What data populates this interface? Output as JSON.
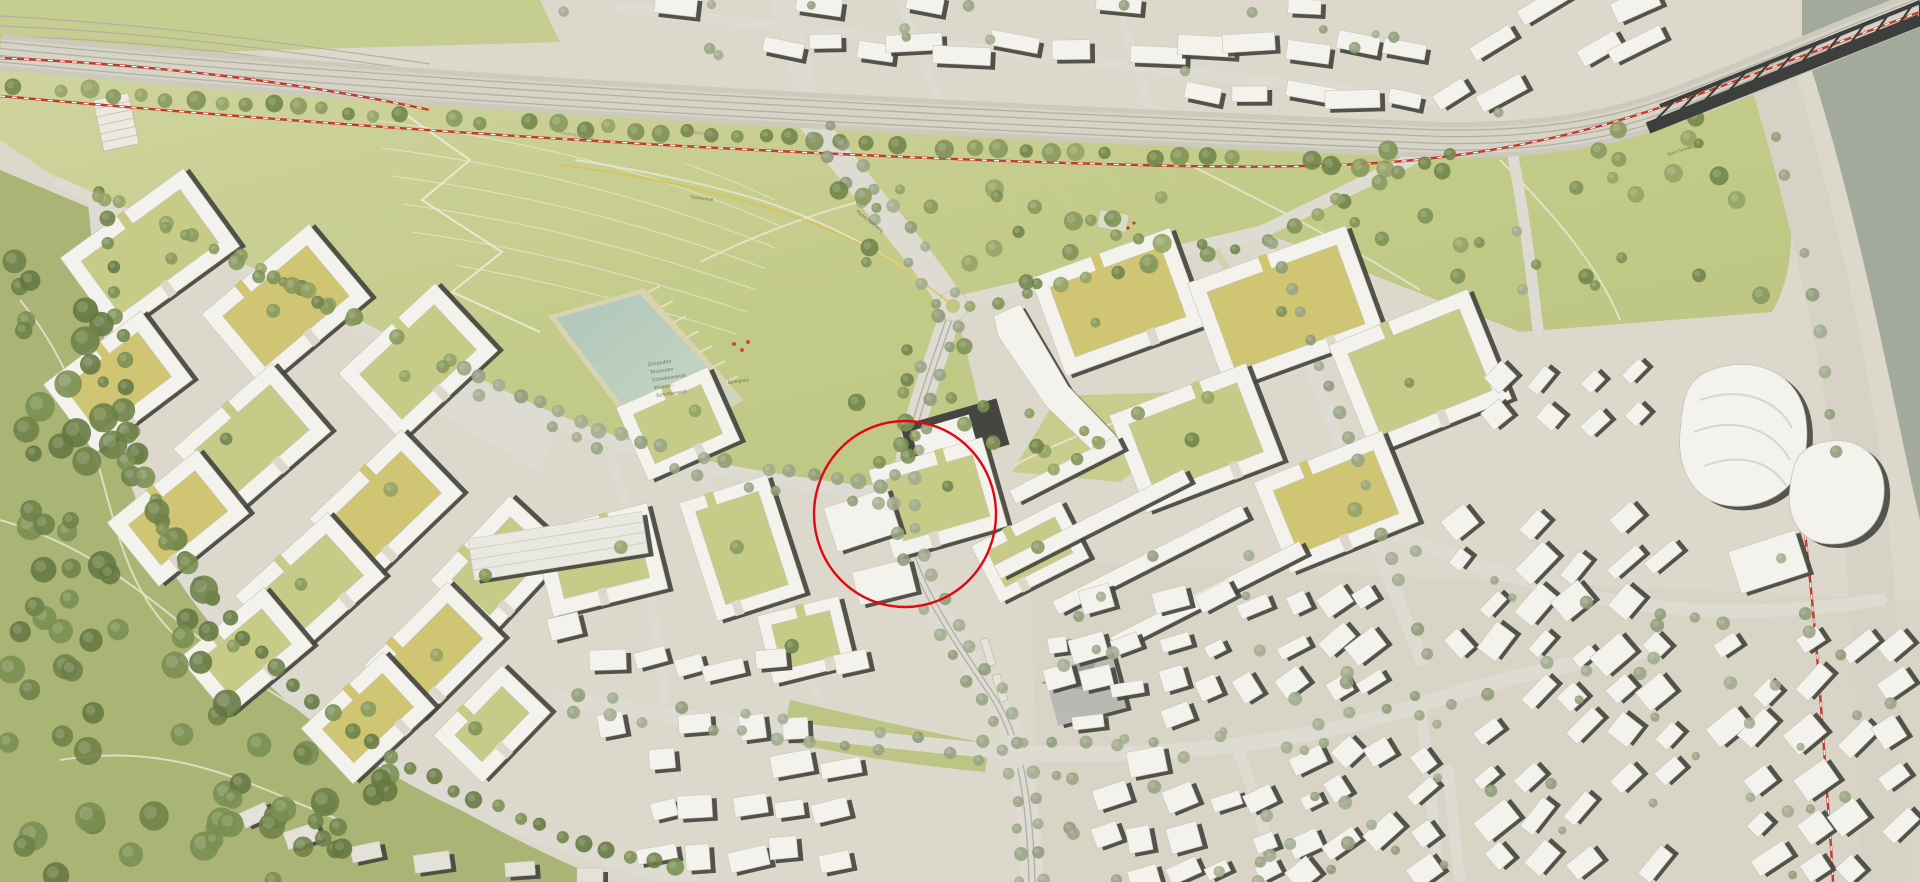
{
  "map": {
    "type": "masterplan-site-plan",
    "annotation_circle": {
      "cx": 905,
      "cy": 514,
      "rx": 91,
      "ry": 93,
      "color": "#e30613"
    },
    "labels": {
      "pond": {
        "lines": [
          "Sitzstufen",
          "Terrassen",
          "Schwimmteich",
          "Wasser-",
          "Schilfbereich"
        ]
      },
      "playground_slope": "Spielplatz",
      "rail_corridor": "Bahntrasse",
      "bike_highway_west": "Radschnellweg",
      "bike_highway_center": "Radschnellweg",
      "bike_long_distance": "Rad-Fernweg",
      "play_meadow": "Spielwiese"
    },
    "palette": {
      "ground": "#dcd9cc",
      "old_town_ground": "#d8d4c6",
      "street": "#deDCd2",
      "street2": "#dedcd2",
      "park_light": "#ced39b",
      "park_mid": "#c0c985",
      "park_dark": "#aab573",
      "hill": "#a9b475",
      "tree_park": "#7d9154",
      "tree_street": "#97a483",
      "building": "#f3f2ec",
      "building_shadow": "#45463f",
      "building_gray": "#b9b8b2",
      "courtyard_green": "#c6cb87",
      "courtyard_yellow": "#cfc573",
      "pond_water": "#b5cabd",
      "river": "#a3aa9b",
      "quay": "#d6d3c6",
      "rail_band": "#ccc9bd",
      "rail_track": "#b2afa3",
      "route_red": "#c23a2c",
      "route_yellow": "#d8c24a",
      "bridge": "#3d3f3c",
      "annotation_red": "#e30613"
    }
  }
}
